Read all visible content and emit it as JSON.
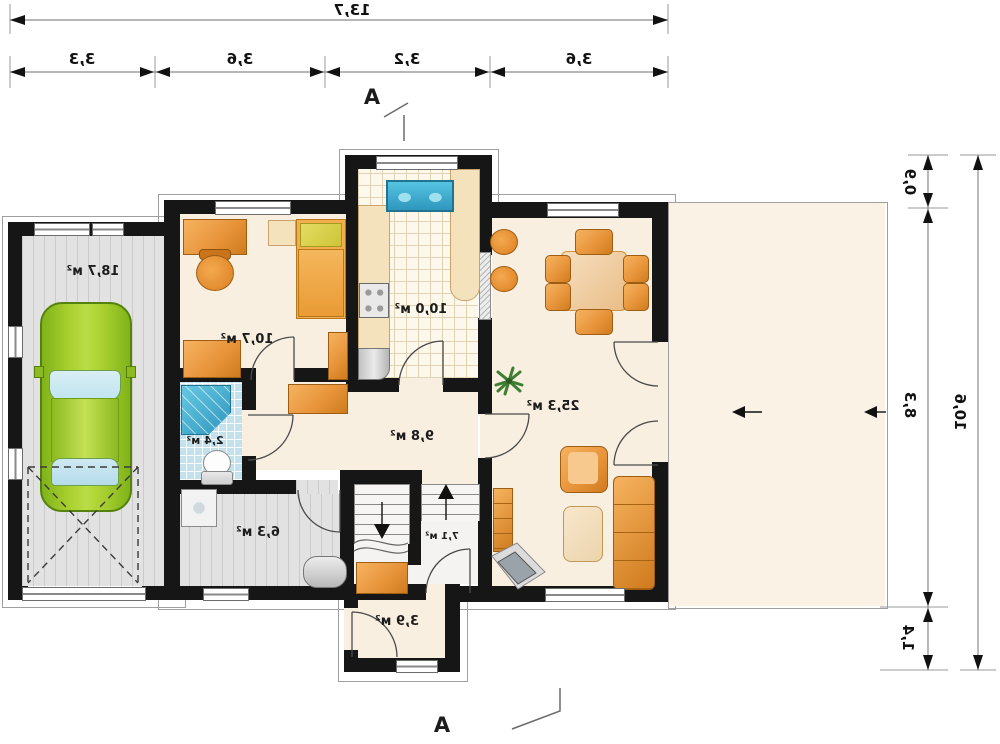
{
  "meta": {
    "type": "mirrored architectural floor plan, ground floor with garage and terrace"
  },
  "dimensions": {
    "top_total": "13,7",
    "top_segments": [
      "3,3",
      "3,6",
      "3,2",
      "3,6"
    ],
    "right_total": "10,6",
    "right_segments": [
      "0,9",
      "8,3",
      "1,4"
    ]
  },
  "section_marks": {
    "top": "A",
    "bottom": "A"
  },
  "rooms": [
    {
      "name": "garage",
      "area_label": "18,7 м²"
    },
    {
      "name": "bedroom",
      "area_label": "10,7 м²"
    },
    {
      "name": "kitchen",
      "area_label": "10,0 м²"
    },
    {
      "name": "living-dining",
      "area_label": "25,3 м²"
    },
    {
      "name": "hall",
      "area_label": "9,8 м²"
    },
    {
      "name": "bathroom",
      "area_label": "2,4 м²"
    },
    {
      "name": "utility",
      "area_label": "6,3 м²"
    },
    {
      "name": "stairs",
      "area_label": "7,1 м²"
    },
    {
      "name": "entry",
      "area_label": "3,9 м²"
    }
  ],
  "colors": {
    "wall": "#161616",
    "floor_cream": "#f8efe0",
    "terrace": "#faf3e5",
    "furniture_orange": "#e8953c",
    "car_green": "#9cc21f",
    "water_blue": "#3fadd1",
    "tile_blue": "#c3e2ee",
    "floor_gray": "#e2e2e2"
  }
}
